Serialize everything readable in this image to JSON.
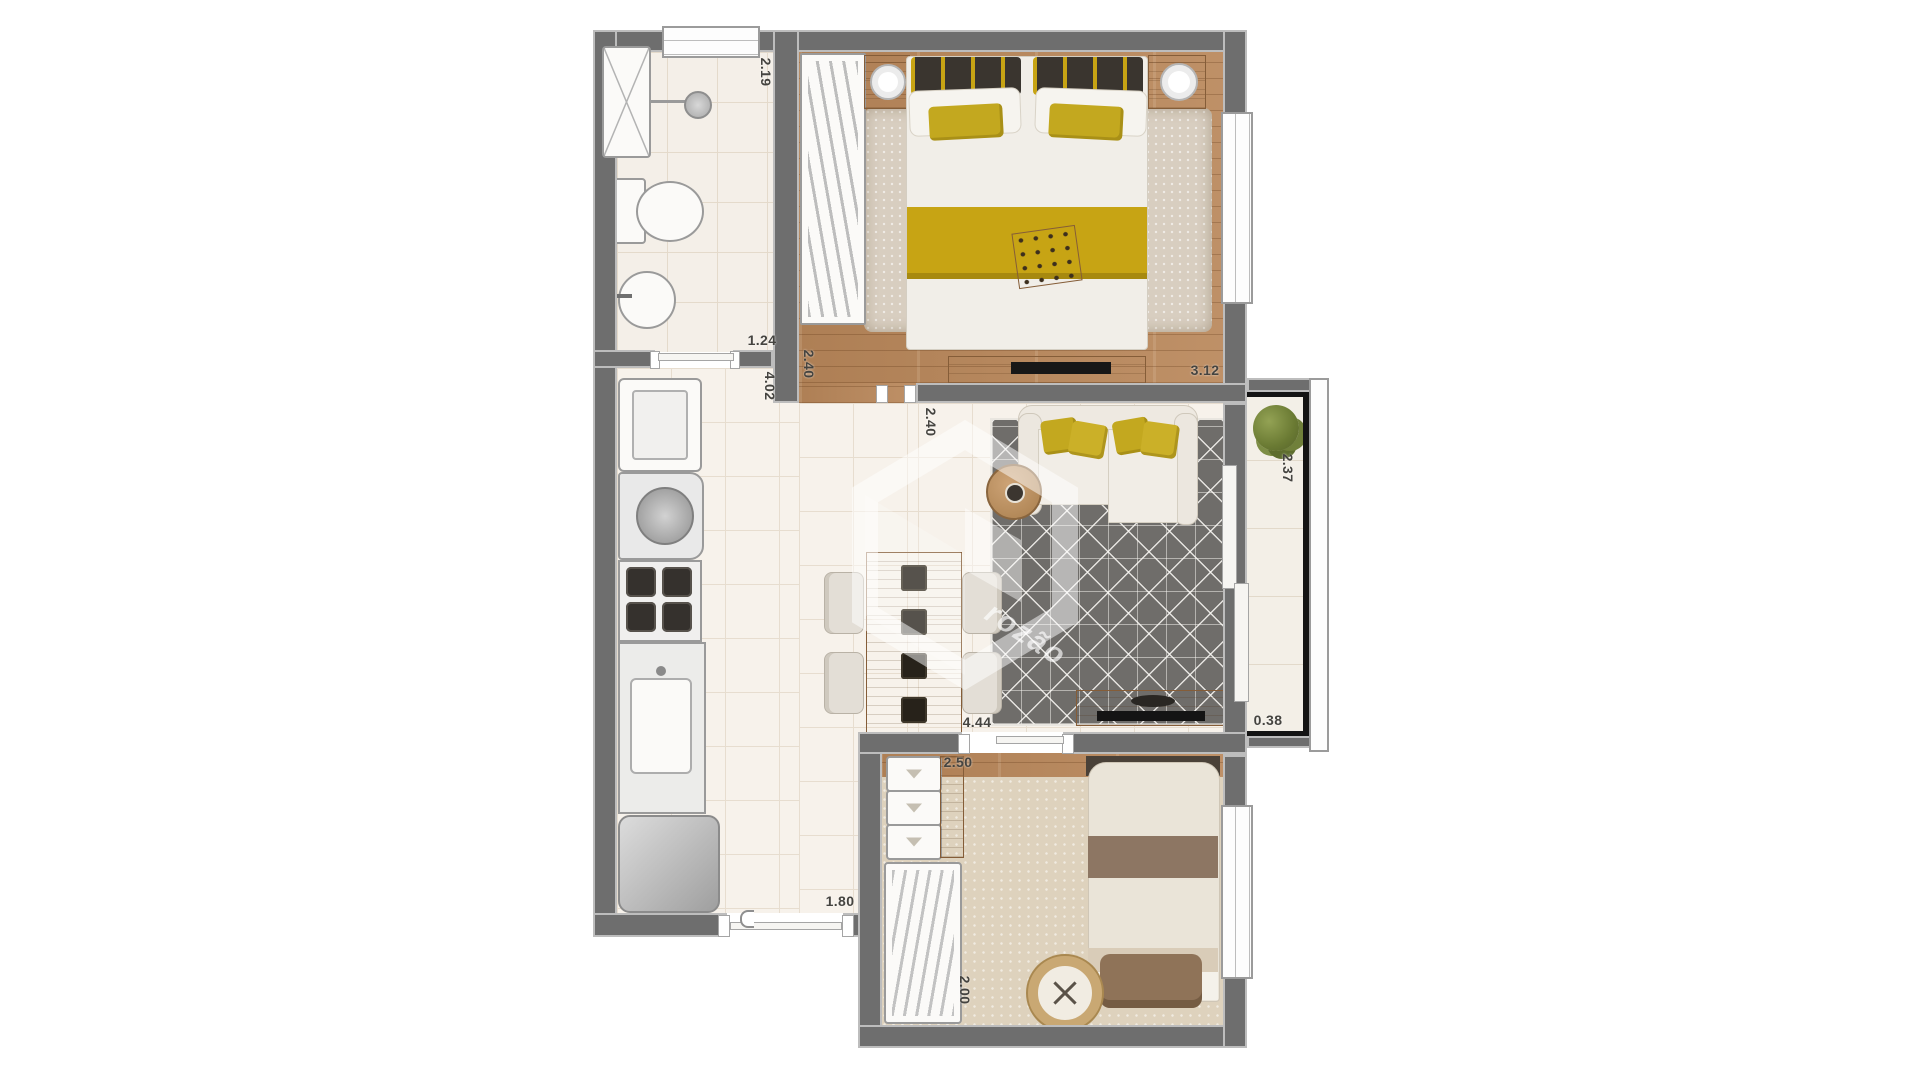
{
  "watermark": {
    "text": "rozão"
  },
  "dimensions": {
    "bathroom_width": "2.19",
    "bath_passage": "1.24",
    "kitchen_length": "4.02",
    "bedroom1_entry": "2.40",
    "bedroom1_width": "3.12",
    "living_depth": "2.40",
    "balcony_length": "2.37",
    "living_width": "4.44",
    "balcony_width": "0.38",
    "bedroom2_width": "2.50",
    "entry_width": "1.80",
    "bedroom2_depth": "2.00"
  },
  "colors": {
    "wall": "#6e6e6e",
    "wood_floor": "#b9875a",
    "accent_yellow": "#c7a414",
    "living_rug": "#6f6d6a",
    "tile_floor": "#f7f2eb",
    "bedroom2_carpet": "#ded2bd",
    "balcony_railing": "#141414"
  }
}
